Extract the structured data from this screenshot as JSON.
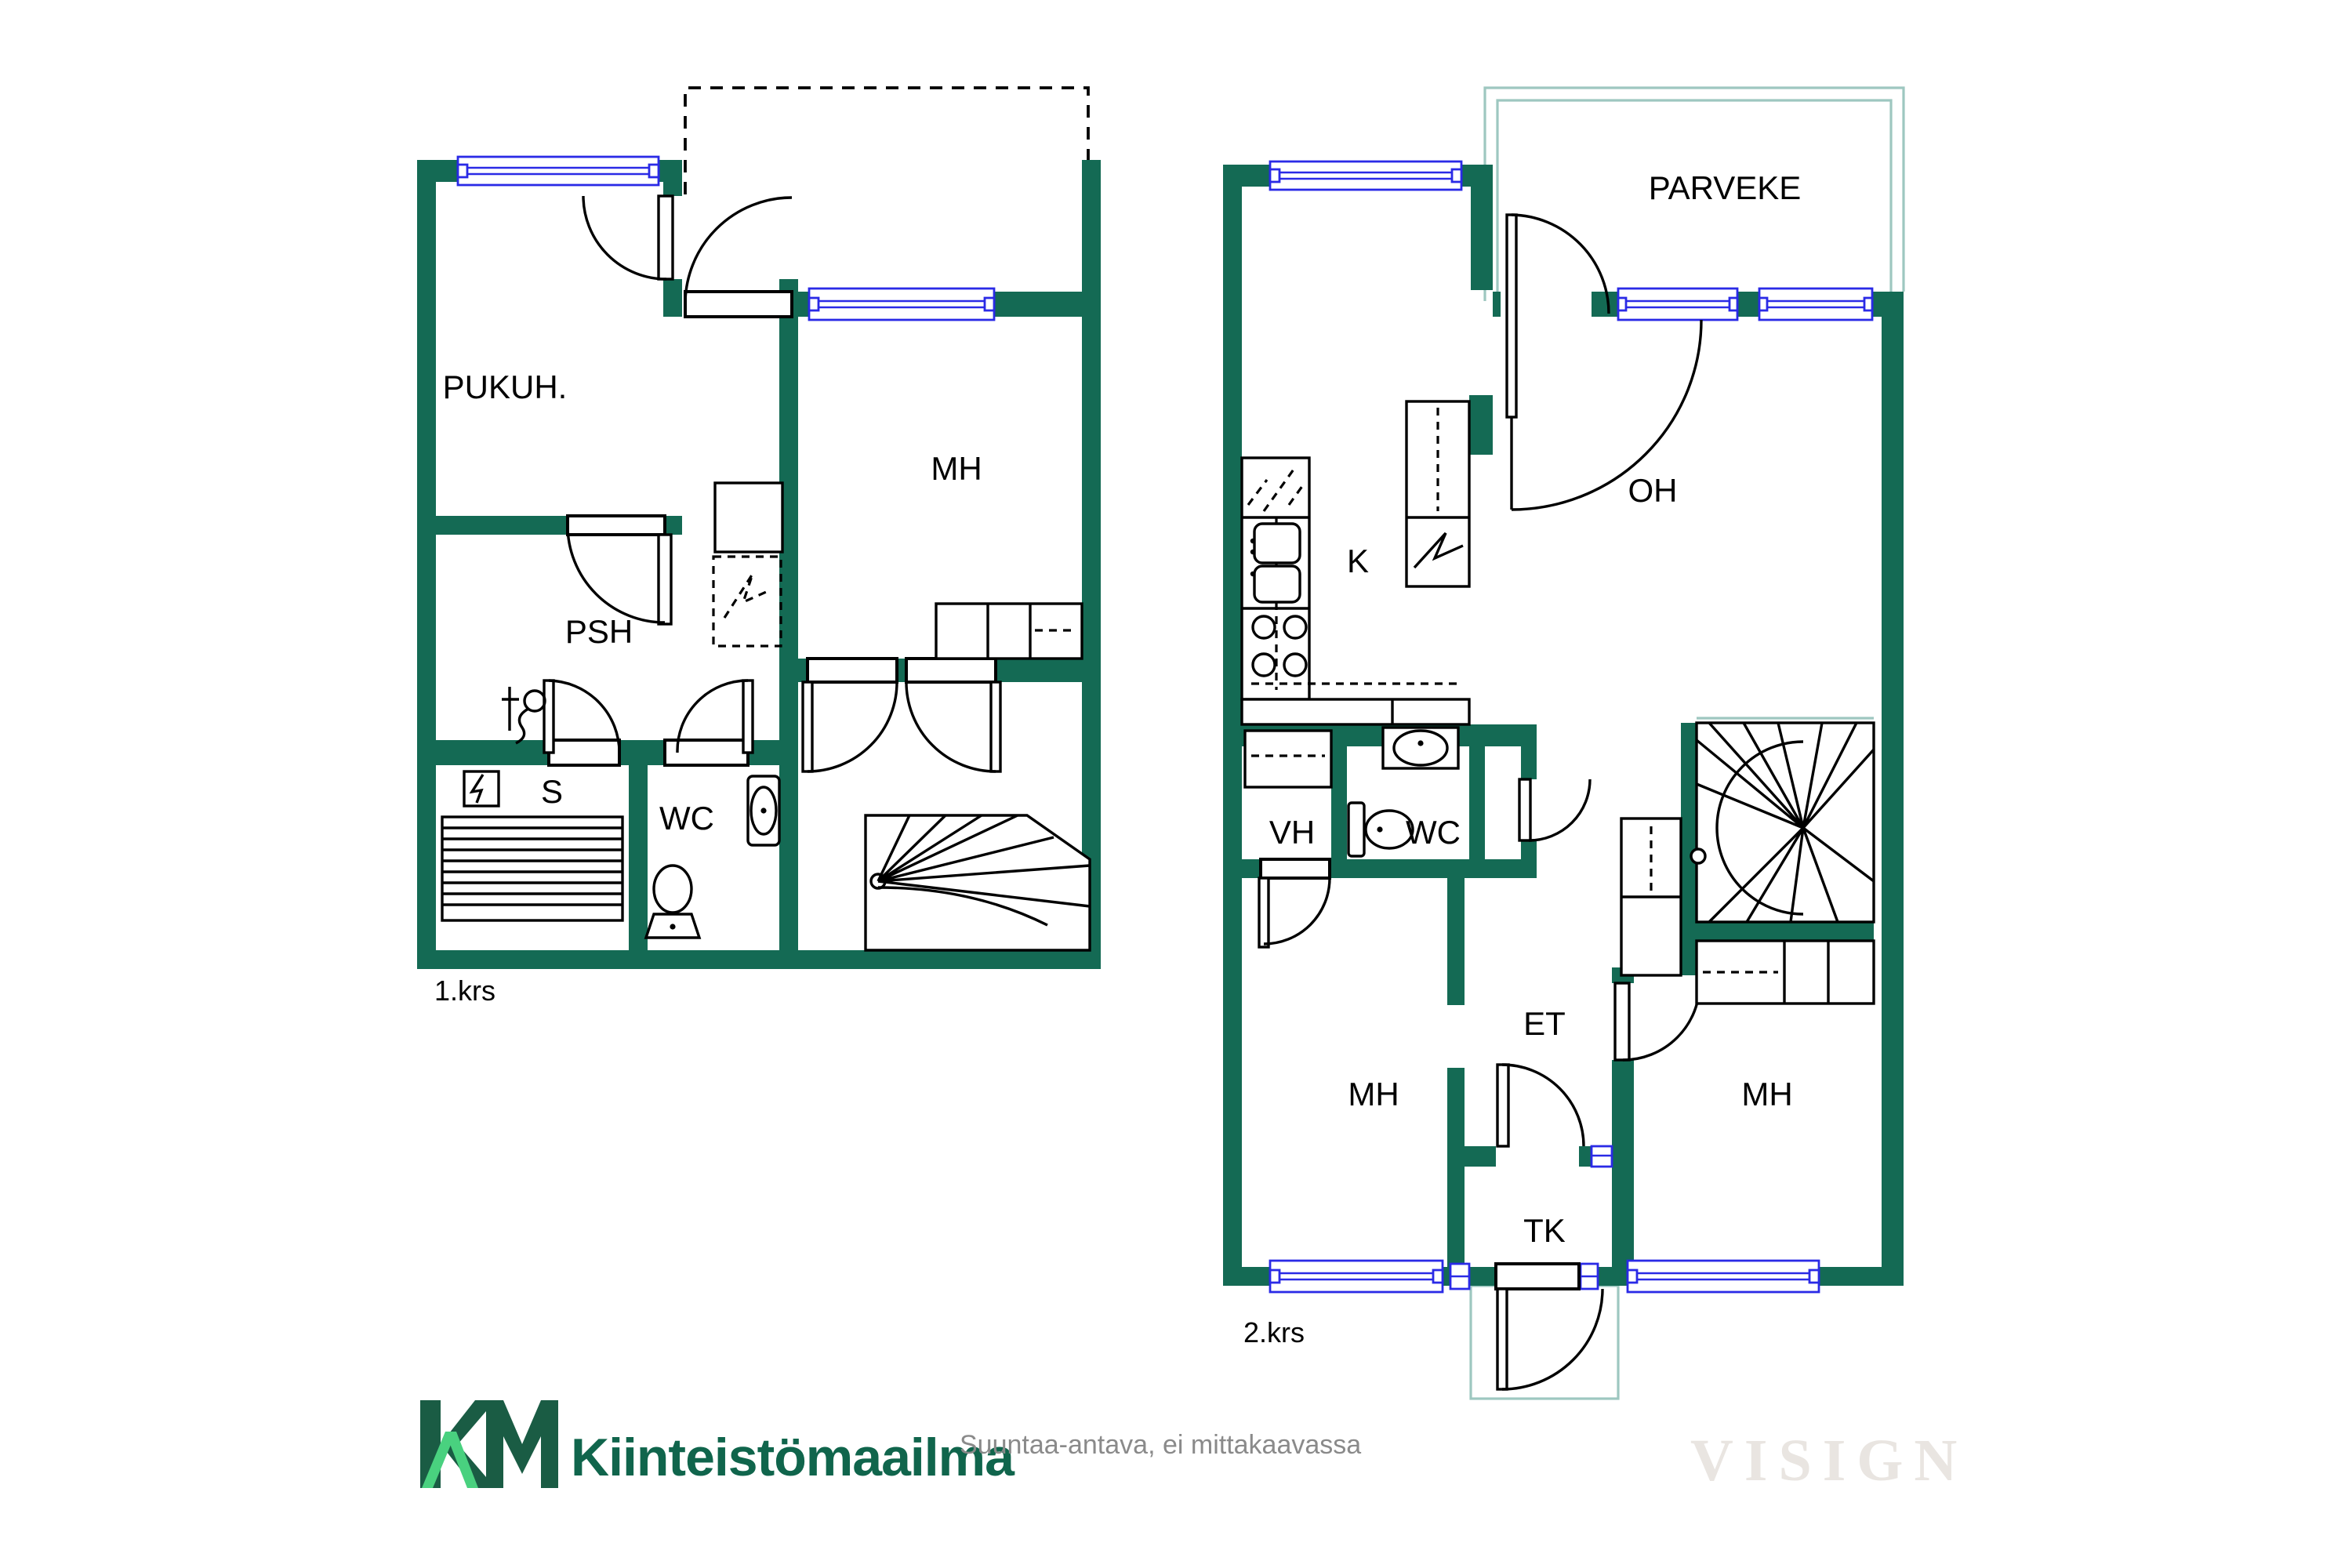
{
  "floor1": {
    "caption": "1.krs",
    "rooms": {
      "pukuh": "PUKUH.",
      "mh": "MH",
      "psh": "PSH",
      "s": "S",
      "wc": "WC"
    }
  },
  "floor2": {
    "caption": "2.krs",
    "rooms": {
      "parveke": "PARVEKE",
      "oh": "OH",
      "k": "K",
      "vh": "VH",
      "wc": "WC",
      "et": "ET",
      "tk": "TK",
      "mh_left": "MH",
      "mh_right": "MH"
    }
  },
  "footer": {
    "brand": "Kiinteistömaailma",
    "disclaimer": "Suuntaa-antava, ei mittakaavassa",
    "watermark": "VISIGN"
  },
  "colors": {
    "wall": "#146a54",
    "window": "#2a2ae6",
    "outline_light": "#9ec7c0",
    "logo_dark": "#1a5c44",
    "logo_accent": "#49d17f",
    "logo_text": "#10654c",
    "disclaimer": "#8a8a8a",
    "watermark": "#e9e5e1"
  }
}
